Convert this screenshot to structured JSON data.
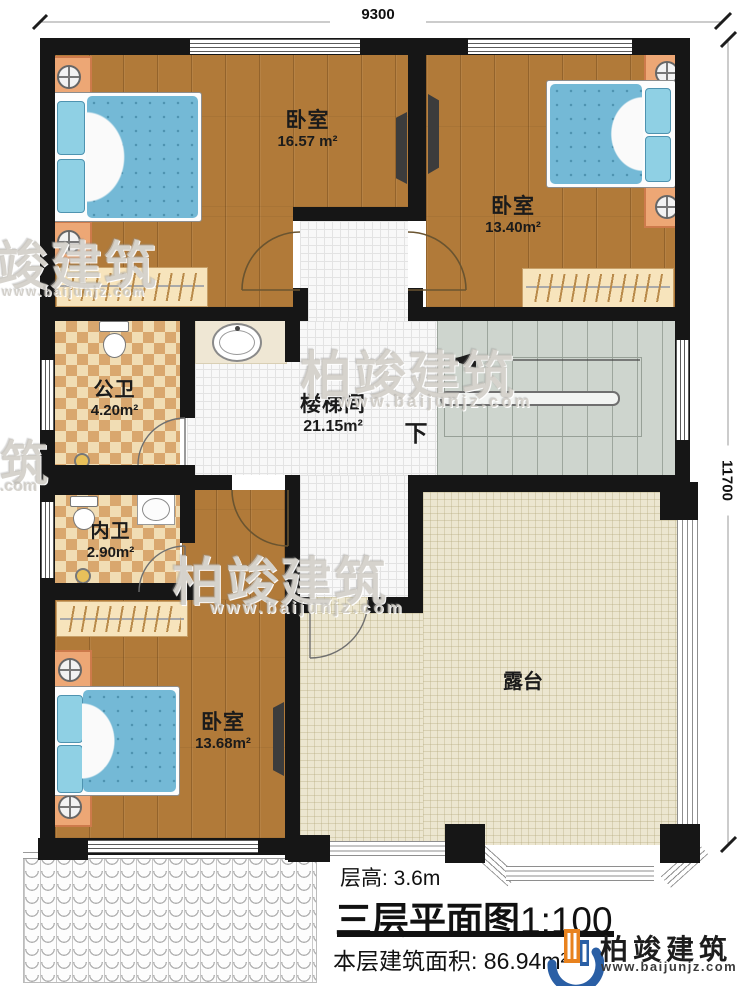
{
  "dimensions": {
    "top_width": "9300",
    "right_height": "11700"
  },
  "rooms": {
    "bedroom_top_left": {
      "name": "卧室",
      "area": "16.57 m²"
    },
    "bedroom_top_right": {
      "name": "卧室",
      "area": "13.40m²"
    },
    "public_bathroom": {
      "name": "公卫",
      "area": "4.20m²"
    },
    "inner_bathroom": {
      "name": "内卫",
      "area": "2.90m²"
    },
    "stairwell": {
      "name": "楼梯间",
      "area": "21.15m²"
    },
    "bedroom_bottom": {
      "name": "卧室",
      "area": "13.68m²"
    },
    "terrace": {
      "name": "露台"
    }
  },
  "stairs": {
    "down_label": "下"
  },
  "title_block": {
    "floor_height": "层高: 3.6m",
    "plan_title": "三层平面图",
    "scale": "1:100",
    "floor_area": "本层建筑面积: 86.94m²"
  },
  "brand": {
    "name": "柏竣建筑",
    "website": "www.baijunjz.com"
  },
  "watermarks": {
    "edge_char": "筑",
    "edge_site": ".com"
  },
  "colors": {
    "wall": "#161616",
    "wood_floor": "#b17a39",
    "bath_tile": "#d9a76e",
    "terrace_floor": "#ece6d0",
    "stair_floor": "#ced5ce",
    "bed_blue": "#74b9d6",
    "brand_blue": "#2a5fa5",
    "brand_orange": "#e8821e"
  }
}
